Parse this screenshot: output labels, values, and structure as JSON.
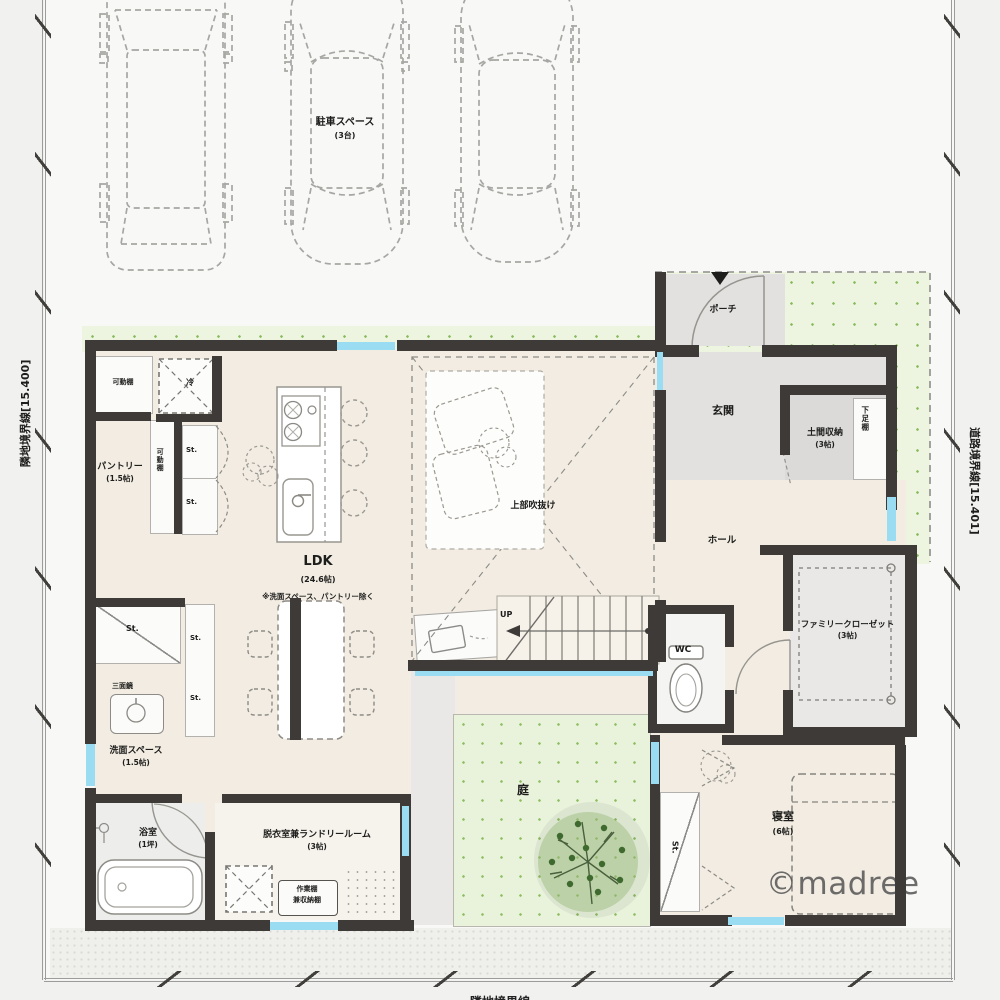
{
  "boundaries": {
    "left": "隣地境界線[15.400]",
    "right": "道路境界線[15.401]",
    "bottom": "隣地境界線"
  },
  "parking": {
    "name": "駐車スペース",
    "count": "(3台)"
  },
  "rooms": {
    "porch": "ポーチ",
    "genkan": "玄関",
    "doma": "土間収納",
    "doma_size": "(3帖)",
    "shoe_shelf": "下足棚",
    "hall": "ホール",
    "wc": "WC",
    "fcl": "ファミリークローゼット",
    "fcl_size": "(3帖)",
    "bedroom": "寝室",
    "bedroom_size": "(6帖)",
    "ldk": "LDK",
    "ldk_size": "(24.6帖)",
    "ldk_note": "※洗面スペース、パントリー除く",
    "pantry": "パントリー",
    "pantry_size": "(1.5帖)",
    "washroom": "洗面スペース",
    "washroom_size": "(1.5帖)",
    "bathroom": "浴室",
    "bathroom_size": "(1坪)",
    "laundry": "脱衣室兼ランドリールーム",
    "laundry_size": "(3帖)",
    "garden": "庭",
    "void_above": "上部吹抜け",
    "stairs_up": "UP"
  },
  "fixtures": {
    "movable_shelf": "可動棚",
    "fridge": "冷",
    "storage": "St.",
    "mirror": "三面鏡",
    "work_shelf_line1": "作業棚",
    "work_shelf_line2": "兼収納棚"
  },
  "watermark": "©madree",
  "colors": {
    "wall": "#3d3a37",
    "window": "#9adcf2",
    "garden_green": "#edf5e1",
    "dot_green": "#84b957",
    "floor_beige": "#f2ece2"
  }
}
